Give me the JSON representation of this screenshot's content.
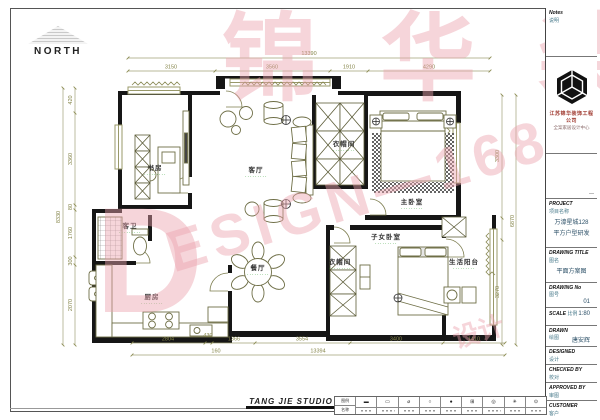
{
  "north": {
    "label": "NORTH"
  },
  "watermark": {
    "big_letter": "D",
    "diagonal_text": "ESIGN—1680",
    "cn_text": "锦华装",
    "small_text": "设计",
    "color": "#eca2ac"
  },
  "plan": {
    "dots": "･････････",
    "rooms": [
      {
        "id": "study",
        "label": "书房"
      },
      {
        "id": "living",
        "label": "客厅"
      },
      {
        "id": "cloak1",
        "label": "衣帽间"
      },
      {
        "id": "master",
        "label": "主卧室"
      },
      {
        "id": "bath",
        "label": "客卫"
      },
      {
        "id": "kitchen",
        "label": "厨房"
      },
      {
        "id": "dining",
        "label": "餐厅"
      },
      {
        "id": "cloak2",
        "label": "衣帽间"
      },
      {
        "id": "kids",
        "label": "子女卧室"
      },
      {
        "id": "balcony",
        "label": "生活阳台"
      }
    ],
    "dims": {
      "top_total": "13390",
      "top": [
        "3150",
        "3560",
        "1910",
        "4290"
      ],
      "bottom": [
        "2804",
        "430",
        "1366",
        "3554",
        "3400",
        "1410"
      ],
      "bottom_sub": "160",
      "bottom_total": "13394",
      "left": [
        "420",
        "3360",
        "80",
        "1760",
        "300",
        "2070"
      ],
      "left_total": "8330",
      "right": [
        "3300",
        "3270"
      ],
      "right_total": "6870"
    }
  },
  "titleblock": {
    "notes_en": "Notes",
    "notes_cn": "说明",
    "company": "江苏锦华装饰工程公司",
    "company_sub": "全案家居设计中心",
    "project_en": "PROJECT",
    "project_cn": "项目名称",
    "project_line1": "万濠星城128",
    "project_line2": "平方户型研发",
    "drawing_title_en": "DRAWING TITLE",
    "drawing_title_cn": "图名",
    "drawing_title_value": "平面方案图",
    "drawing_no_en": "DRAWING No",
    "drawing_no_cn": "图号",
    "drawing_no_value": "01",
    "scale_en": "SCALE",
    "scale_cn": "比例",
    "scale_value": "1:80",
    "drawn_en": "DRAWN",
    "drawn_cn": "绘图",
    "drawn_value": "唐安辉",
    "designed_en": "DESIGNED",
    "designed_cn": "设计",
    "checked_en": "CHECKED BY",
    "checked_cn": "校对",
    "approved_en": "APPROVED BY",
    "approved_cn": "审图",
    "customer_en": "CUSTOMER",
    "customer_cn": "客户"
  },
  "footer": {
    "studio": "TANG JIE STUDIO",
    "legend": {
      "header_top": "图例",
      "header_bottom": "名称",
      "symbols": [
        "▬",
        "▭",
        "⌀",
        "○",
        "●",
        "⊞",
        "◎",
        "✳",
        "⊙"
      ]
    }
  },
  "colors": {
    "wall": "#161616",
    "dimension": "#85854a",
    "room_dot": "#2e9e2e",
    "watermark_pink": "#eca2ac"
  }
}
